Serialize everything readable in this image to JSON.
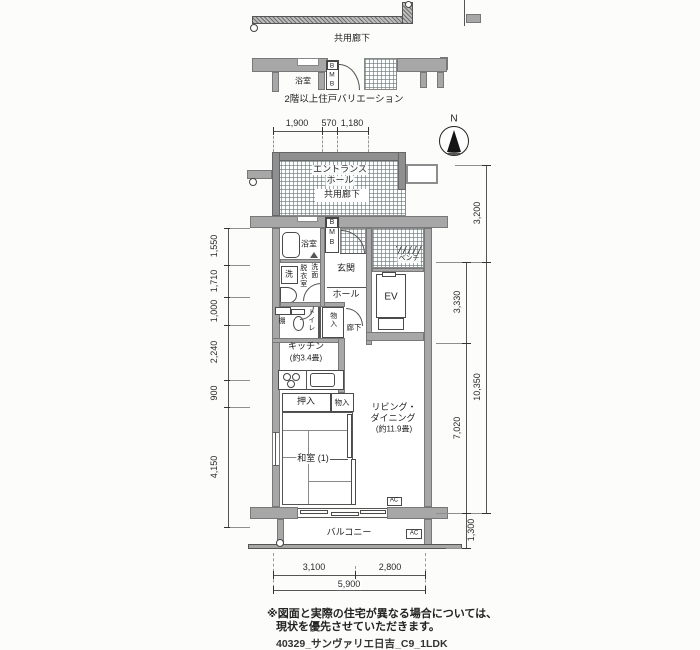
{
  "colors": {
    "wall_gray": "#a7a7a7",
    "hatch_line": "#607070",
    "ink": "#1f1f1f"
  },
  "header": {
    "upper_corridor_label": "共用廊下",
    "variation_caption": "2階以上住戸バリエーション",
    "variation_bath": "浴室",
    "meter_letters": [
      "B",
      "M",
      "B"
    ]
  },
  "compass": {
    "label": "N"
  },
  "dims": {
    "top": [
      "1,900",
      "570",
      "1,180"
    ],
    "left": [
      "1,550",
      "1,710",
      "1,000",
      "2,240",
      "900",
      "4,150"
    ],
    "right_outer": [
      "3,200",
      "10,350"
    ],
    "right_inner": [
      "3,330",
      "7,020",
      "1,300"
    ],
    "bottom": [
      "3,100",
      "2,800"
    ],
    "bottom_total": "5,900"
  },
  "plan": {
    "entrance_hall": [
      "エントランス",
      "ホール"
    ],
    "common_corridor": "共用廊下",
    "bath": "浴室",
    "washer": "洗",
    "dressing": "脱衣室",
    "basin": "洗面",
    "meter_letters": [
      "B",
      "M",
      "B"
    ],
    "genkan": "玄関",
    "bench": "ベンチ",
    "ev": "EV",
    "hall": "ホール",
    "shelf": "棚",
    "toilet": "トイレ",
    "closet_hall": "物入",
    "corridor": "廊下",
    "kitchen": [
      "キッチン",
      "(約3.4畳)"
    ],
    "oshiire": "押入",
    "closet_ld": "物入",
    "living": [
      "リビング・",
      "ダイニング",
      "(約11.9畳)"
    ],
    "washitsu": "和室 (1)",
    "balcony": "バルコニー",
    "ac_label": "AC"
  },
  "footer": {
    "disclaimer": [
      "※図面と実際の住宅が異なる場合については、",
      "現状を優先させていただきます。"
    ],
    "drawing_id": "40329_サンヴァリエ日吉_C9_1LDK"
  }
}
